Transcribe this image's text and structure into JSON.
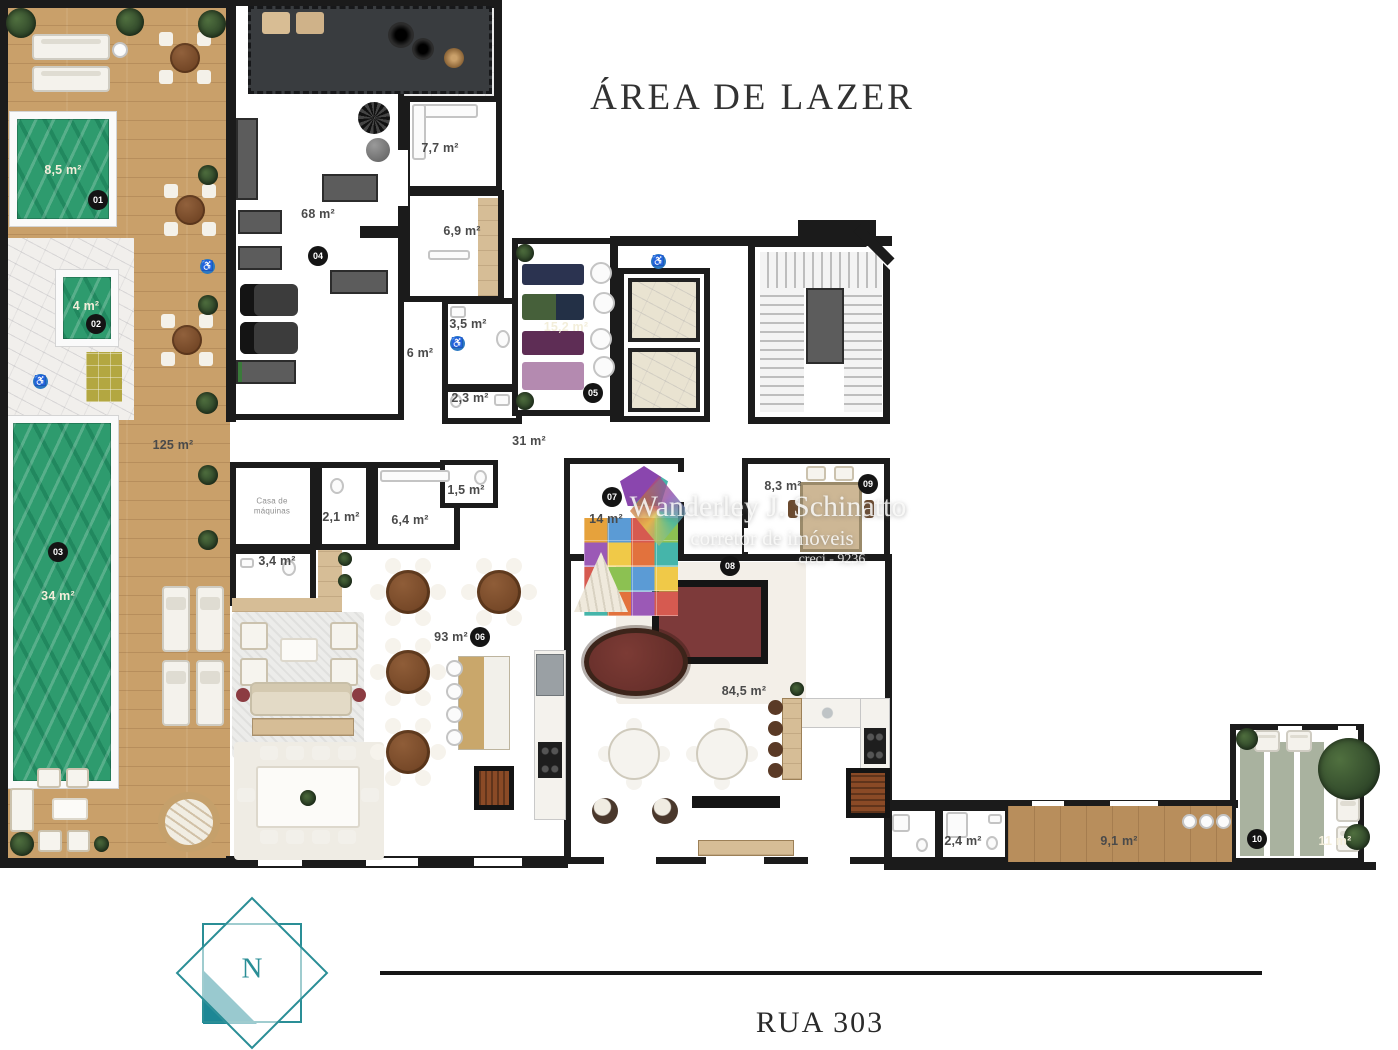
{
  "title": "ÁREA DE LAZER",
  "street": {
    "name": "RUA 303"
  },
  "compass": {
    "north": "N"
  },
  "watermark": {
    "name": "Wanderley J. Schinatto",
    "role": "corretor de imóveis",
    "registry": "creci - 9236"
  },
  "markers": {
    "m01": "01",
    "m02": "02",
    "m03": "03",
    "m04": "04",
    "m05": "05",
    "m06": "06",
    "m07": "07",
    "m08": "08",
    "m09": "09",
    "m10": "10"
  },
  "areas": {
    "pool_spa": "8,5 m²",
    "plunge_pool": "4 m²",
    "main_pool": "34 m²",
    "deck": "125 m²",
    "gym": "68 m²",
    "sauna": "7,7 m²",
    "changing_room": "6,9 m²",
    "wc_35": "3,5 m²",
    "hall_6": "6 m²",
    "wc_23": "2,3 m²",
    "yoga_studio": "15,2 m²",
    "hall_31": "31 m²",
    "machine_room": "Casa de máquinas",
    "wc_21": "2,1 m²",
    "locker_room": "6,4 m²",
    "wc_15": "1,5 m²",
    "wc_34": "3,4 m²",
    "kids_room": "14 m²",
    "meeting_room": "8,3 m²",
    "lounge": "93 m²",
    "party_room": "84,5 m²",
    "wc_24": "2,4 m²",
    "service_corridor": "9,1 m²",
    "garden": "11 m²"
  },
  "icons": {
    "accessible": "♿"
  },
  "colors": {
    "accent_teal": "#2a8e96",
    "water_green": "#2e9b6e",
    "wall_black": "#1b1b1b"
  }
}
